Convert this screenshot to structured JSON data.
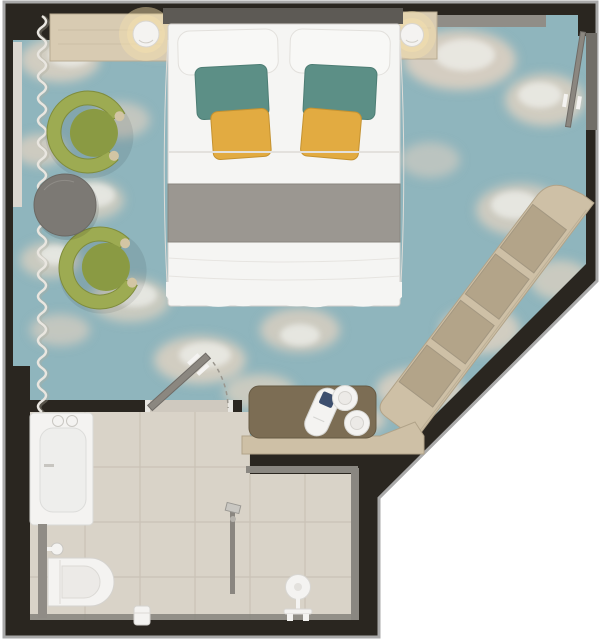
{
  "meta": {
    "type": "floor-plan",
    "view": "top-down rendered plan",
    "scene": "Hotel guest room with en-suite bathroom, angled corner wall",
    "width_px": 600,
    "height_px": 639
  },
  "colors": {
    "outside": "#ffffff",
    "wall": "#2a2620",
    "outline": "#a9a9a9",
    "recess": "#716e68",
    "carpet": "#8fb5bd",
    "cloud_beige": "#d8cfc1",
    "cloud_white": "#f3f4f1",
    "sill": "#dbd7d0",
    "tile": "#d9d3c8",
    "tile_line": "#c6bfb2",
    "trim_gray": "#8a8781",
    "threshold": "#cfc9bf",
    "wood_light": "#d8cbb2",
    "wood_mid": "#cec0a6",
    "wood_inset": "#b3a489",
    "desk_brown": "#7c6d54",
    "pelmet": "#908d87",
    "headboard": "#5d5a55",
    "bed_white": "#f5f5f3",
    "bed_shadow": "#dedcd8",
    "blanket_gray": "#9b9791",
    "pillow_teal": "#5c8f86",
    "pillow_yellow": "#e2ab41",
    "chair_olive": "#9dab52",
    "chair_seat": "#8a9a43",
    "chair_trim": "#d2c5a4",
    "table_gray": "#7c7974",
    "fixture_white": "#f4f3f1",
    "fixture_stroke": "#d2d0cc",
    "door_leaf": "#8b8780",
    "half_wall": "#908c86",
    "lamp_glow": "#f3dfae",
    "curtain": "#e9e6e0",
    "shower_rail": "#8a8680",
    "kettle_screen": "#3d4f6e"
  },
  "rooms": [
    {
      "id": "bedroom",
      "label": "Bedroom",
      "floor": "sky-and-clouds patterned carpet"
    },
    {
      "id": "bathroom",
      "label": "Bathroom",
      "floor": "beige stone tile"
    }
  ],
  "furniture": [
    {
      "id": "bed",
      "label": "Double bed: white linens, grey foot runner, 2 white + 2 teal + 2 mustard pillows"
    },
    {
      "id": "nightstand-left",
      "label": "Wood nightstand console with glowing lamp"
    },
    {
      "id": "nightstand-right",
      "label": "Wood nightstand with glowing lamp"
    },
    {
      "id": "armchair-1",
      "label": "Olive green tub armchair"
    },
    {
      "id": "armchair-2",
      "label": "Olive green tub armchair"
    },
    {
      "id": "side-table",
      "label": "Round grey side table"
    },
    {
      "id": "shelving-unit",
      "label": "Open wood shelving console along diagonal wall, 4 compartments"
    },
    {
      "id": "desk",
      "label": "Brown desk / minibar top with kettle and 2 cups on saucers"
    },
    {
      "id": "curtain",
      "label": "Wavy curtain along left window wall"
    }
  ],
  "bathroom_fixtures": [
    {
      "id": "bathtub",
      "label": "Bathtub with two deck taps"
    },
    {
      "id": "toilet",
      "label": "Wall-hung toilet with flush valve"
    },
    {
      "id": "toilet-paper",
      "label": "Toilet paper holder"
    },
    {
      "id": "shower",
      "label": "Walk-in shower with rail"
    },
    {
      "id": "mixer-tap",
      "label": "White mixer tap fitting on bottom wall"
    }
  ],
  "doors": [
    {
      "id": "bathroom-door",
      "label": "Swing door shown open with dashed swing arc"
    },
    {
      "id": "connecting-door",
      "label": "Open door leaf folded along right wall"
    }
  ],
  "counts": {
    "pillows_white": 2,
    "pillows_teal": 2,
    "pillows_yellow": 2,
    "armchairs": 2,
    "cups": 2,
    "kettles": 1,
    "shelf_compartments": 4
  }
}
